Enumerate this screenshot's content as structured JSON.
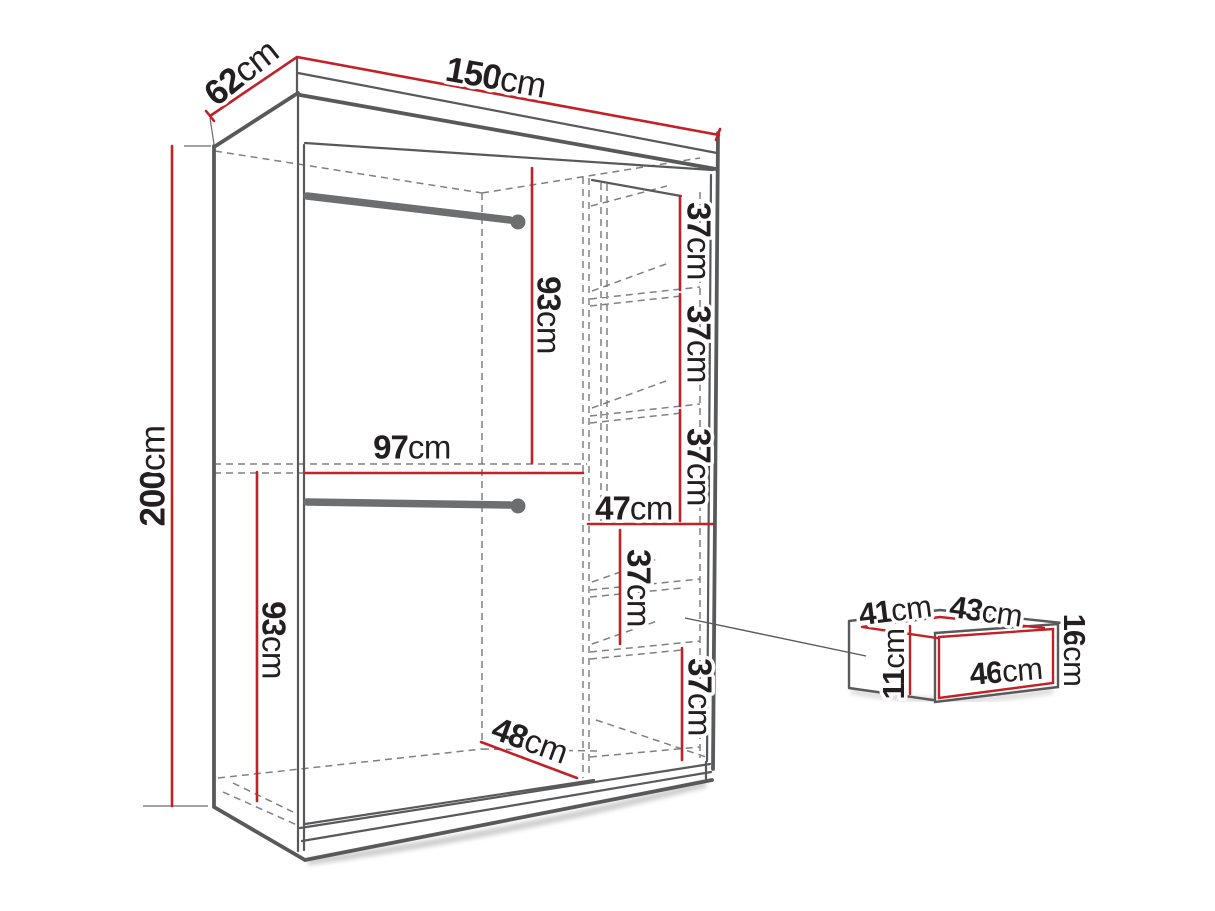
{
  "figure": {
    "kind": "furniture dimension line-drawing",
    "subject": "wardrobe with shelves, two hanging rails and pull-out drawer detail",
    "unit": "cm"
  },
  "colors": {
    "background": "#ffffff",
    "dimension_red": "#c32127",
    "structure_gray": "#58595b",
    "rail_gray": "#6d6e70",
    "hidden_edge_gray": "#7e8082",
    "text_black": "#231f20"
  },
  "dims": {
    "width": {
      "value": "150",
      "unit": "cm"
    },
    "depth": {
      "value": "62",
      "unit": "cm"
    },
    "height": {
      "value": "200",
      "unit": "cm"
    },
    "upper_section_height": {
      "value": "93",
      "unit": "cm"
    },
    "left_inner_width": {
      "value": "97",
      "unit": "cm"
    },
    "lower_section_height": {
      "value": "93",
      "unit": "cm"
    },
    "shelf_gap_1": {
      "value": "37",
      "unit": "cm"
    },
    "shelf_gap_2": {
      "value": "37",
      "unit": "cm"
    },
    "shelf_gap_3": {
      "value": "37",
      "unit": "cm"
    },
    "right_inner_width": {
      "value": "47",
      "unit": "cm"
    },
    "drawer_gap_1": {
      "value": "37",
      "unit": "cm"
    },
    "drawer_gap_2": {
      "value": "37",
      "unit": "cm"
    },
    "bottom_inner_depth": {
      "value": "48",
      "unit": "cm"
    },
    "drawer_top_left": {
      "value": "41",
      "unit": "cm"
    },
    "drawer_top_right": {
      "value": "43",
      "unit": "cm"
    },
    "drawer_front_height": {
      "value": "16",
      "unit": "cm"
    },
    "drawer_side_height": {
      "value": "11",
      "unit": "cm"
    },
    "drawer_front_width": {
      "value": "46",
      "unit": "cm"
    }
  }
}
